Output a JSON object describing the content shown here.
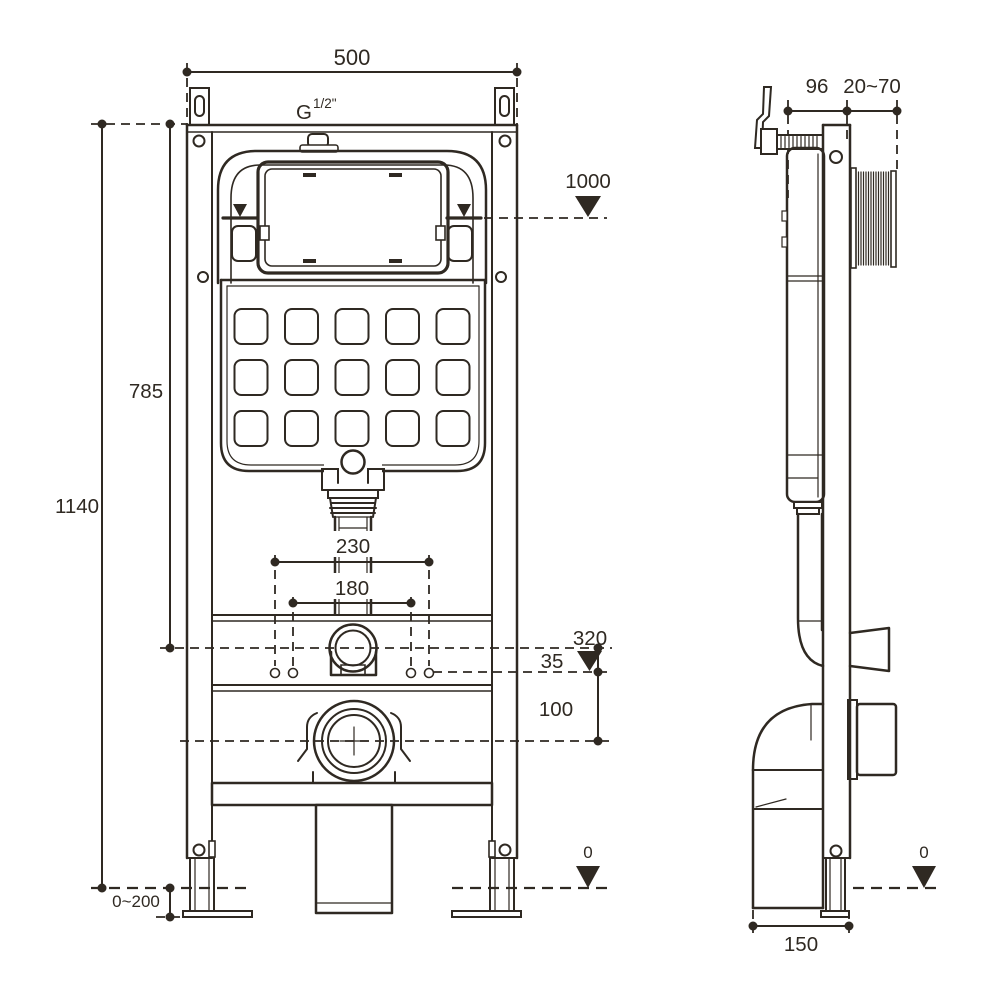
{
  "colors": {
    "line": "#2f2922",
    "background": "#ffffff"
  },
  "front_view": {
    "dims": {
      "width_top": "500",
      "thread_g": "G",
      "thread_size": "1/2\"",
      "level_1000": "1000",
      "height_785": "785",
      "height_total": "1140",
      "spread_230": "230",
      "spread_180": "180",
      "level_320": "320",
      "offset_35": "35",
      "offset_100": "100",
      "adjust_range": "0~200",
      "level_floor": "0"
    }
  },
  "side_view": {
    "dims": {
      "depth_96": "96",
      "wall_range": "20~70",
      "base_depth": "150",
      "level_floor": "0"
    }
  }
}
